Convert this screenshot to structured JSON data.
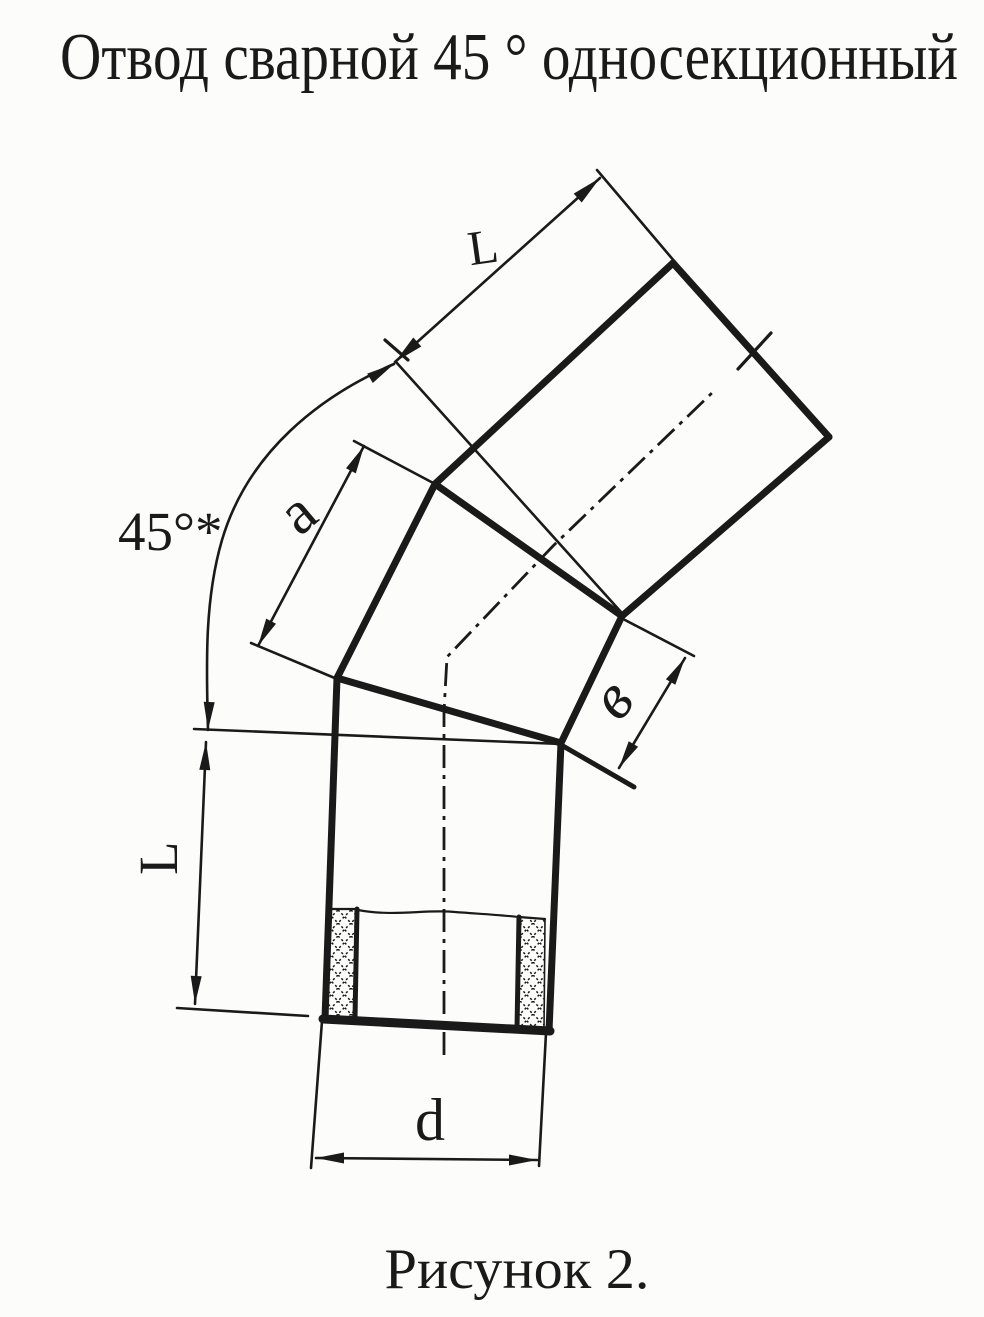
{
  "title": "Отвод сварной 45 ° односекционный",
  "caption": "Рисунок 2.",
  "dimension_labels": {
    "top_pipe_length": "L",
    "bend_angle": "45°*",
    "segment_outer_edge": "a",
    "segment_inner_edge": "в",
    "bottom_pipe_length": "L",
    "diameter": "d"
  },
  "colors": {
    "ink": "#1a1a1a",
    "paper": "#fcfcfa"
  }
}
